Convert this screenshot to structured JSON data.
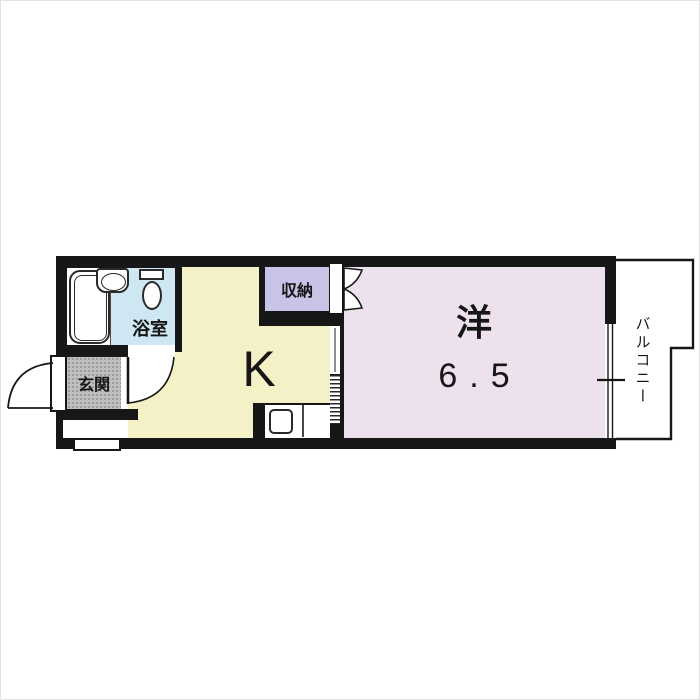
{
  "image_type": "apartment-floor-plan",
  "rooms": {
    "bathroom": {
      "label": "浴室",
      "color": "#cfe7f2"
    },
    "entrance": {
      "label": "玄関",
      "color": "#bfbfbf"
    },
    "kitchen": {
      "label": "K",
      "color": "#f5f1c6"
    },
    "closet": {
      "label": "収納",
      "color": "#c8c3e7"
    },
    "western_room": {
      "label": "洋",
      "size_tatami": "6.5",
      "color": "#ede1ed"
    },
    "balcony": {
      "label": "バルコニー",
      "color": "#ffffff"
    }
  },
  "wall_color": "#171717",
  "fixtures": [
    "bathtub",
    "washbasin",
    "toilet",
    "kitchen-sink",
    "kitchen-counter",
    "entrance-door-swing",
    "bathroom-door-swing",
    "closet-bifold-door",
    "sliding-window",
    "partition-accordion-door",
    "entry-step",
    "exterior-step"
  ]
}
